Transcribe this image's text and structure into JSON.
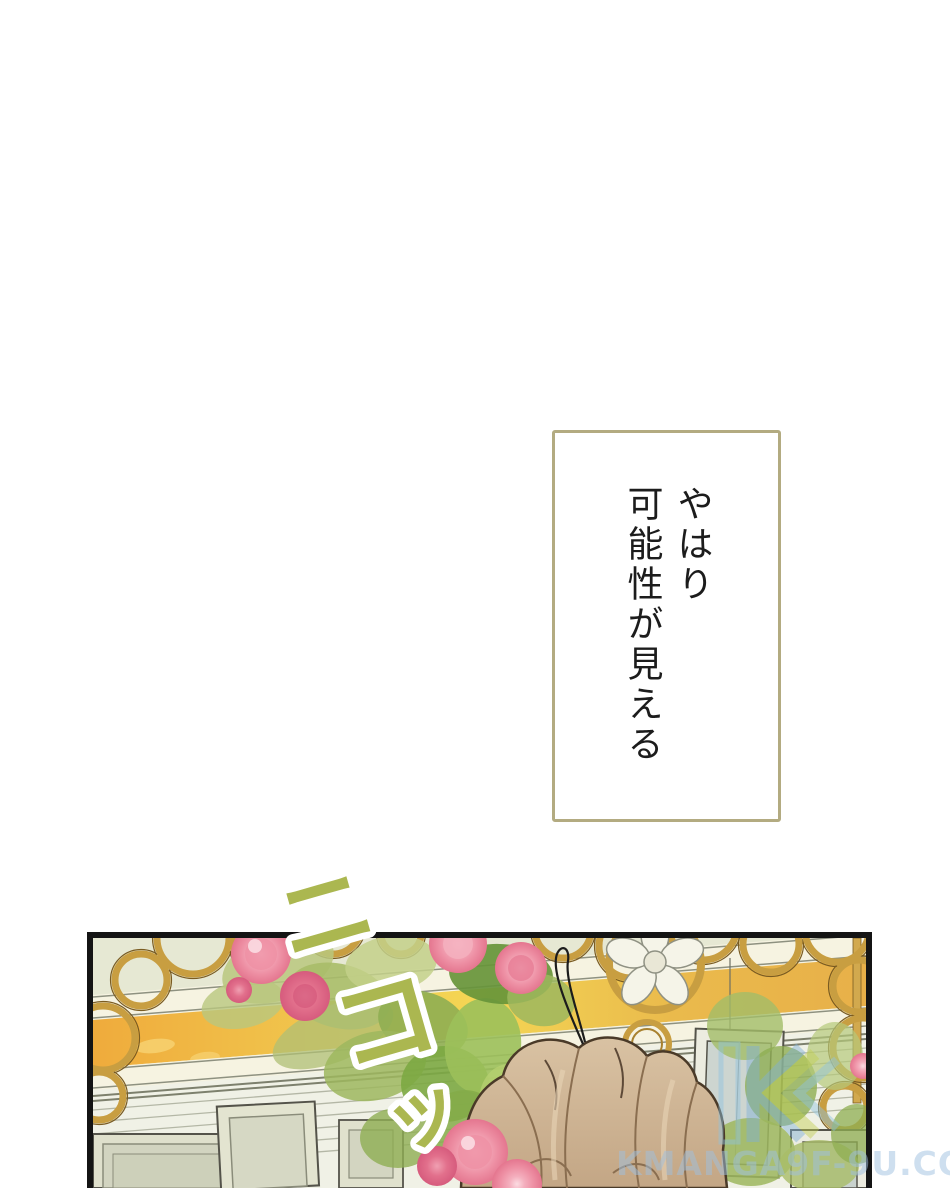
{
  "bubble": {
    "lines": [
      "やはり",
      "可能性が見える"
    ]
  },
  "sfx": {
    "text": "ニコッ",
    "chars": [
      "ニ",
      "コ",
      "ッ"
    ]
  },
  "watermark": {
    "text": "KMANGA9F-9U.COM"
  },
  "colors": {
    "bubble_border": "#b3ab81",
    "ink": "#1c1c1c",
    "sfx_green": "#abb750",
    "panel_border": "#141414",
    "wall_sage": "#e6e8d3",
    "watermark_blue": "#9fc0e0",
    "band_orange": "#efac3e",
    "band_yellow": "#f4d654",
    "molding_cream": "#f6f3e1",
    "gold": "#c89e41",
    "leaf_green": "#8fae52",
    "rose_pink": "#ee91a5",
    "hair_tan": "#c9ad8c"
  }
}
